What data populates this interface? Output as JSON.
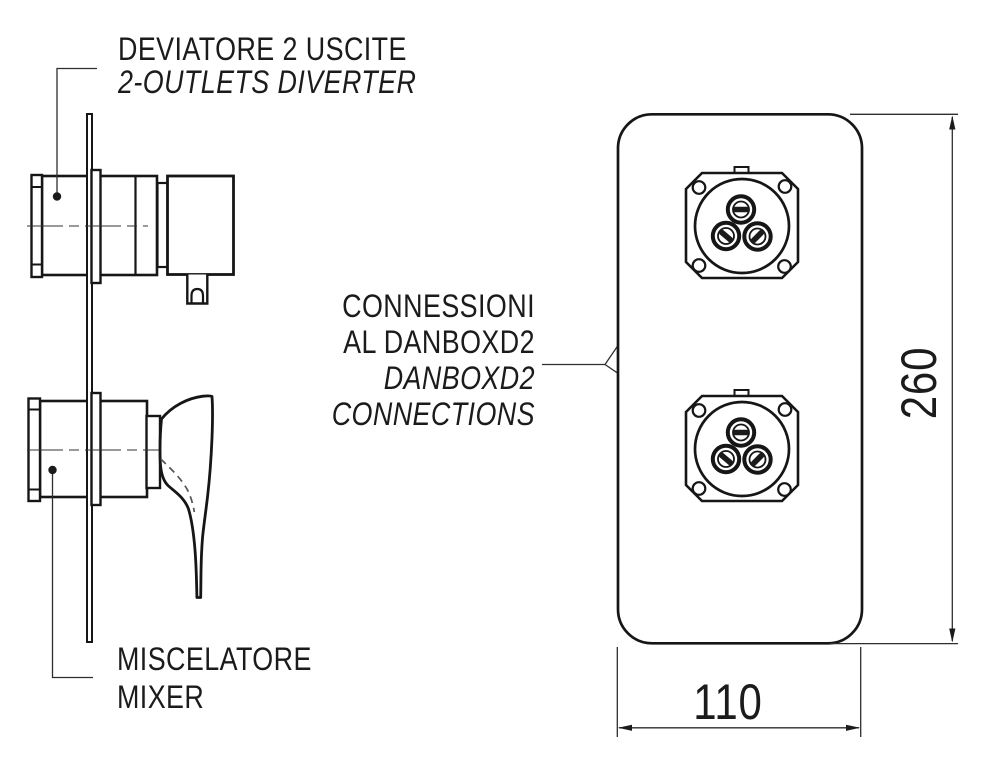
{
  "colors": {
    "background": "#ffffff",
    "line": "#161616",
    "thin_line": "#333333"
  },
  "labels": {
    "diverter": {
      "it": "DEVIATORE 2 USCITE",
      "en": "2-OUTLETS DIVERTER"
    },
    "connections": {
      "it1": "CONNESSIONI",
      "it2": "AL DANBOXD2",
      "en1": "DANBOXD2",
      "en2": "CONNECTIONS"
    },
    "mixer": {
      "it": "MISCELATORE",
      "en": "MIXER"
    }
  },
  "dimensions": {
    "height": "260",
    "width": "110"
  }
}
